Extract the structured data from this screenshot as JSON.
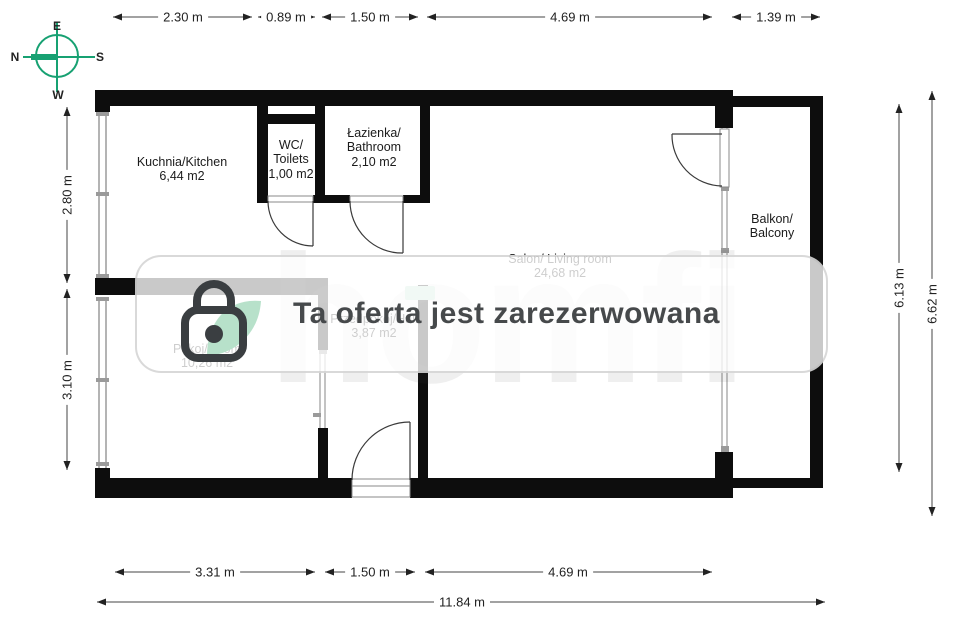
{
  "title": "apartment-floor-plan",
  "compass": {
    "e": "E",
    "n": "N",
    "s": "S",
    "w": "W"
  },
  "rooms": {
    "kitchen": {
      "name": "Kuchnia/Kitchen",
      "area": "6,44 m2"
    },
    "wc": {
      "name": "WC/",
      "name_en": "Toilets",
      "area": "1,00 m2"
    },
    "bathroom": {
      "name": "Łazienka/",
      "name_en": "Bathroom",
      "area": "2,10 m2"
    },
    "living": {
      "name": "Salon/ Living room",
      "area": "24,68 m2"
    },
    "room": {
      "name": "Pokoj/Room",
      "area": "10,26 m2"
    },
    "hall": {
      "name": "Przedpokój/Hall",
      "area": "3,87 m2"
    },
    "balcony": {
      "name": "Balkon/",
      "name_en": "Balcony"
    }
  },
  "dimensions": {
    "top": [
      "2.30 m",
      "0.89 m",
      "1.50 m",
      "4.69 m",
      "1.39 m"
    ],
    "left": [
      "2.80 m",
      "3.10 m"
    ],
    "right": [
      "6.13 m",
      "6.62 m"
    ],
    "bottom": [
      "3.31 m",
      "1.50 m",
      "4.69 m"
    ],
    "total_width": "11.84 m"
  },
  "overlay": {
    "banner_text": "Ta oferta jest zarezerwowana",
    "logo_text": "homfi"
  },
  "colors": {
    "compass_green": "#17a172",
    "mint": "#b7e1ca",
    "wall": "#0d0d0d",
    "banner_text": "#46494b"
  }
}
